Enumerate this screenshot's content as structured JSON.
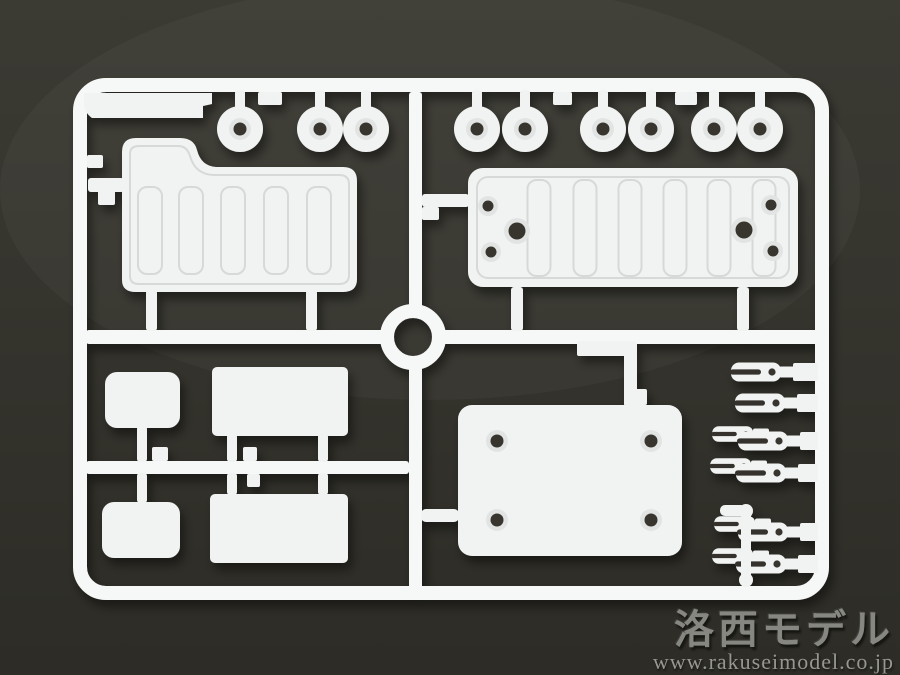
{
  "watermark": {
    "brand": "洛西モデル",
    "url": "www.rakuseimodel.co.jp"
  },
  "photo": {
    "subject": "White plastic model kit parts runner (sprue) photographed on a dark gray-olive surface",
    "colors": {
      "bg_top": "#3b3a33",
      "bg_bottom": "#2d2c26",
      "slot": "#34332d",
      "plastic": "#f1f3f2",
      "plastic_bright": "#f6f8f7",
      "recess": "#e1e4e2",
      "groove": "#d6d9d7",
      "hole": "#38362f",
      "wm_brand": "#9b9b97",
      "wm_url": "#a9a9a5"
    },
    "frame": {
      "x": 80,
      "y": 85,
      "w": 742,
      "h": 508,
      "rx": 26,
      "t": 14
    },
    "center_ring": {
      "cx": 413,
      "cy": 337,
      "r": 26,
      "t": 14
    },
    "mid_rail": {
      "y": 330,
      "h": 14,
      "seg1": [
        86,
        387
      ],
      "seg2": [
        439,
        822
      ]
    },
    "divider": {
      "x": 409,
      "w": 13,
      "seg1": [
        92,
        311
      ],
      "seg2": [
        363,
        591
      ]
    },
    "tag_plate": {
      "path": "M84,93 L212,93 L212,104 L203,106 L203,118 L92,118 Q84,112 84,104 Z"
    },
    "left_frame_tab": [
      87,
      155,
      16,
      13
    ],
    "top_rings": {
      "cy": 129,
      "r": 23,
      "recess_r": 11,
      "hole_r": 6.5,
      "stem_w": 10,
      "stem_top": 90,
      "cx": [
        240,
        320,
        366,
        477,
        525,
        603,
        651,
        714,
        760
      ]
    },
    "top_tabs": [
      [
        258,
        24
      ],
      [
        553,
        19
      ],
      [
        675,
        22
      ]
    ],
    "left_panel": {
      "outline": "M122,280 L122,152 Q122,138 136,138 L180,138 Q194,138 197,150 Q201,166 216,167 L343,167 Q357,167 357,181 L357,279 Q357,292 343,292 L136,292 Q122,292 122,280 Z",
      "groove": "M130,276 L130,154 Q130,146 139,146 L178,146 Q187,146 190,156 Q195,174 213,175 L339,175 Q349,175 349,184 L349,275 Q349,284 339,284 L139,284 Q130,284 130,276 Z",
      "ribs": {
        "y": 187,
        "h": 87,
        "w": 24,
        "rx": 9,
        "cx": [
          150,
          191,
          233,
          276,
          319
        ]
      },
      "left_stub": [
        88,
        178,
        36,
        14
      ],
      "left_gate": [
        98,
        190,
        17,
        15
      ],
      "bottom_stubs": [
        [
          146,
          290,
          11,
          41
        ],
        [
          306,
          290,
          11,
          41
        ]
      ]
    },
    "right_panel": {
      "rect": [
        468,
        168,
        330,
        119
      ],
      "rx": 15,
      "groove": [
        477,
        177,
        312,
        101
      ],
      "groove_rx": 11,
      "ribs": {
        "y": 180,
        "h": 96,
        "w": 23,
        "rx": 9,
        "cx": [
          539,
          585,
          630,
          675,
          719,
          764
        ]
      },
      "holes": [
        {
          "cx": 488,
          "cy": 206,
          "r": 5.5
        },
        {
          "cx": 491,
          "cy": 252,
          "r": 5.5
        },
        {
          "cx": 517,
          "cy": 231,
          "r": 8.5
        },
        {
          "cx": 744,
          "cy": 230,
          "r": 8.5
        },
        {
          "cx": 771,
          "cy": 205,
          "r": 5.5
        },
        {
          "cx": 773,
          "cy": 251,
          "r": 5.5
        }
      ],
      "left_stub": [
        422,
        194,
        47,
        13
      ],
      "left_tab": [
        422,
        207,
        17,
        13
      ],
      "bottom_stubs": [
        [
          511,
          287,
          12,
          44
        ],
        [
          737,
          287,
          12,
          44
        ]
      ]
    },
    "bl_quadrant": {
      "rail": [
        86,
        461,
        323,
        13
      ],
      "parts": [
        {
          "rect": [
            105,
            372,
            75,
            56
          ],
          "rx": 12
        },
        {
          "rect": [
            212,
            367,
            136,
            69
          ],
          "rx": 5
        },
        {
          "rect": [
            102,
            502,
            78,
            56
          ],
          "rx": 12
        },
        {
          "rect": [
            210,
            494,
            138,
            69
          ],
          "rx": 5
        }
      ],
      "stubs": [
        [
          137,
          426,
          10,
          36
        ],
        [
          227,
          434,
          10,
          28
        ],
        [
          318,
          434,
          10,
          28
        ],
        [
          137,
          473,
          10,
          30
        ],
        [
          227,
          473,
          10,
          22
        ],
        [
          318,
          473,
          10,
          22
        ]
      ],
      "tabs": [
        [
          152,
          447,
          16,
          14
        ],
        [
          243,
          447,
          14,
          14
        ],
        [
          247,
          474,
          13,
          13
        ]
      ]
    },
    "br_plate": {
      "rect": [
        458,
        405,
        224,
        151
      ],
      "rx": 14,
      "holes": [
        {
          "cx": 497,
          "cy": 441
        },
        {
          "cx": 651,
          "cy": 441
        },
        {
          "cx": 497,
          "cy": 520
        },
        {
          "cx": 651,
          "cy": 520
        }
      ],
      "hole_r": 6.5,
      "recess_r": 11,
      "top_rail": [
        624,
        341,
        13,
        66
      ],
      "top_tab": [
        577,
        341,
        50,
        15
      ],
      "top_gate": [
        630,
        389,
        17,
        16
      ],
      "left_stub": [
        421,
        509,
        38,
        13
      ]
    },
    "forks": {
      "rail_x": 818,
      "items": [
        {
          "x": 771,
          "y": 372,
          "gate": true,
          "small": false
        },
        {
          "x": 775,
          "y": 403,
          "gate": true,
          "small": false
        },
        {
          "x": 745,
          "y": 434,
          "gate": false,
          "small": true
        },
        {
          "x": 778,
          "y": 441,
          "gate": true,
          "small": false
        },
        {
          "x": 743,
          "y": 466,
          "gate": false,
          "small": true
        },
        {
          "x": 776,
          "y": 473,
          "gate": true,
          "small": false
        },
        {
          "x": 747,
          "y": 524,
          "gate": false,
          "small": true
        },
        {
          "x": 778,
          "y": 532,
          "gate": true,
          "small": false
        },
        {
          "x": 745,
          "y": 556,
          "gate": false,
          "small": true
        },
        {
          "x": 776,
          "y": 564,
          "gate": true,
          "small": false
        }
      ]
    },
    "pin_part": {
      "bar": [
        741,
        510,
        10,
        68
      ],
      "knobs": [
        [
          746,
          511,
          7
        ],
        [
          746,
          580,
          7
        ]
      ],
      "side": [
        720,
        505,
        26,
        11
      ]
    }
  }
}
